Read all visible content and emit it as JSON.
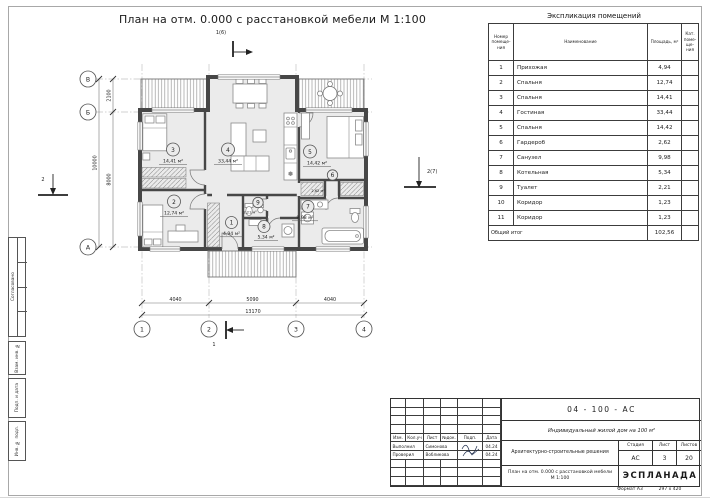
{
  "title": "План на отм. 0.000 с расстановкой мебели М 1:100",
  "plan": {
    "rooms": [
      {
        "num": "1",
        "area": "4,94 м²"
      },
      {
        "num": "2",
        "area": "12,74 м²"
      },
      {
        "num": "3",
        "area": "14,41 м²"
      },
      {
        "num": "4",
        "area": "33,44 м²"
      },
      {
        "num": "5",
        "area": "14,42 м²"
      },
      {
        "num": "6",
        "area": "2,62 м²"
      },
      {
        "num": "7",
        "area": "9,98 м²"
      },
      {
        "num": "8",
        "area": "5,34 м²"
      },
      {
        "num": "9",
        "area": "2,21 м²"
      }
    ],
    "dims": {
      "left_segments": [
        "2100",
        "8000"
      ],
      "left_total": "10000",
      "bottom_segments": [
        "4040",
        "5090",
        "4040"
      ],
      "bottom_total": "13170"
    },
    "axes_left": [
      "В",
      "Б",
      "А"
    ],
    "axes_bottom": [
      "1",
      "2",
      "3",
      "4"
    ],
    "markers": {
      "top": "1(6)",
      "bottom": "1",
      "left": "2",
      "right": "2(7)"
    }
  },
  "icons": {
    "fridge": "❄"
  },
  "schedule": {
    "title": "Экспликация помещений",
    "headers": {
      "num": "Номер\nпомеще-\nния",
      "name": "Наименование",
      "area": "Площадь, м²",
      "cat": "Кат.\nпоме-\nще-\nния"
    },
    "rows": [
      {
        "num": "1",
        "name": "Прихожая",
        "area": "4,94"
      },
      {
        "num": "2",
        "name": "Спальня",
        "area": "12,74"
      },
      {
        "num": "3",
        "name": "Спальня",
        "area": "14,41"
      },
      {
        "num": "4",
        "name": "Гостиная",
        "area": "33,44"
      },
      {
        "num": "5",
        "name": "Спальня",
        "area": "14,42"
      },
      {
        "num": "6",
        "name": "Гардероб",
        "area": "2,62"
      },
      {
        "num": "7",
        "name": "Санузел",
        "area": "9,98"
      },
      {
        "num": "8",
        "name": "Котельная",
        "area": "5,34"
      },
      {
        "num": "9",
        "name": "Туалет",
        "area": "2,21"
      },
      {
        "num": "10",
        "name": "Коридор",
        "area": "1,23"
      },
      {
        "num": "11",
        "name": "Коридор",
        "area": "1,23"
      }
    ],
    "total_label": "Общий итог",
    "total_value": "102,56"
  },
  "titleblock": {
    "doc_number": "04 - 100 - АС",
    "project": "Индивидуальный жилой дом на 100 м²",
    "cols": [
      "Изм.",
      "Кол.уч",
      "Лист",
      "№док.",
      "Подп.",
      "Дата"
    ],
    "crew": [
      {
        "role": "Выполнил",
        "name": "Симонова",
        "date": "04.24"
      },
      {
        "role": "Проверил",
        "name": "Вобликова",
        "date": "04.24"
      }
    ],
    "section": "Архитектурно-строительные решения",
    "sheet_title": "План на отм. 0.000 с расстановкой мебели М 1:100",
    "stage_label": "Стадия",
    "sheet_label": "Лист",
    "sheets_label": "Листов",
    "stage": "АС",
    "sheet": "3",
    "sheets": "20",
    "logo": "ЭСПЛАНАДА"
  },
  "sidebar": {
    "labels": [
      "Согласовано",
      "Взам. инв. №",
      "Подп. и дата",
      "Инв. № подл."
    ]
  },
  "footer": {
    "format_label": "Формат А3",
    "size": "297 х 420"
  },
  "colors": {
    "wall": "#474747",
    "floor": "#ebebeb",
    "line": "#333333"
  }
}
